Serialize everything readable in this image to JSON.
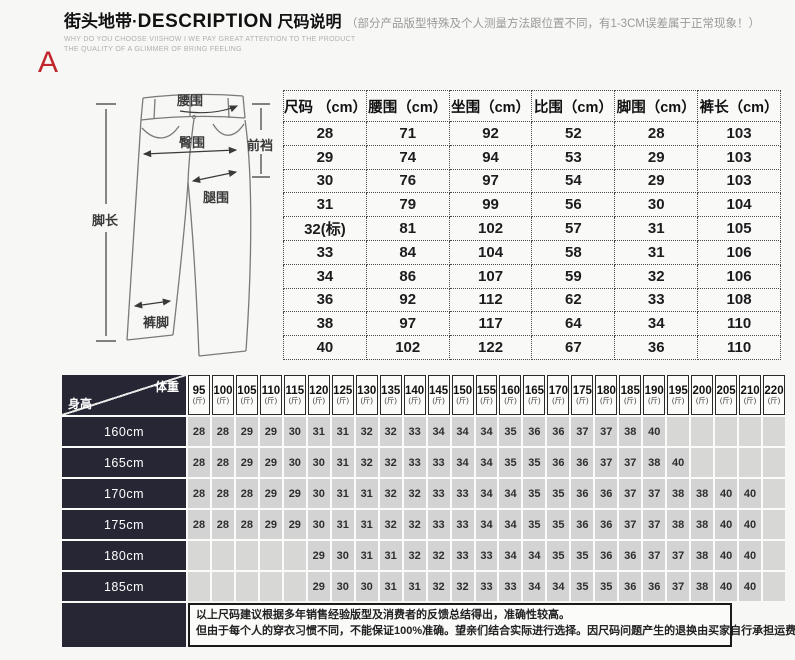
{
  "colors": {
    "accent_red": "#c0262c",
    "dark_header": "#262634",
    "cell_gray": "#d3d3d3"
  },
  "page": {
    "marker_label": "A"
  },
  "header": {
    "brand": "街头地带",
    "dot": "·",
    "title_en": "DESCRIPTION",
    "title_cn": "尺码说明",
    "note": "（部分产品版型特殊及个人测量方法跟位置不同，有1-3CM误差属于正常现象！）",
    "subtitle_line1": "WHY DO YOU CHOOSE VIISHOW I WE PAY GREAT ATTENTION TO THE PRODUCT",
    "subtitle_line2": "THE QUALITY OF A GLIMMER OF BRING FEELING"
  },
  "diagram": {
    "labels": {
      "waist": "腰围",
      "hip": "臀围",
      "front_rise": "前裆",
      "thigh": "腿围",
      "leg_length": "脚长",
      "leg_opening": "裤脚"
    }
  },
  "size_table": {
    "headers": [
      "尺码 （cm）",
      "腰围（cm）",
      "坐围（cm）",
      "比围（cm）",
      "脚围（cm）",
      "裤长（cm）"
    ],
    "rows": [
      [
        "28",
        "71",
        "92",
        "52",
        "28",
        "103"
      ],
      [
        "29",
        "74",
        "94",
        "53",
        "29",
        "103"
      ],
      [
        "30",
        "76",
        "97",
        "54",
        "29",
        "103"
      ],
      [
        "31",
        "79",
        "99",
        "56",
        "30",
        "104"
      ],
      [
        "32(标)",
        "81",
        "102",
        "57",
        "31",
        "105"
      ],
      [
        "33",
        "84",
        "104",
        "58",
        "31",
        "106"
      ],
      [
        "34",
        "86",
        "107",
        "59",
        "32",
        "106"
      ],
      [
        "36",
        "92",
        "112",
        "62",
        "33",
        "108"
      ],
      [
        "38",
        "97",
        "117",
        "64",
        "34",
        "110"
      ],
      [
        "40",
        "102",
        "122",
        "67",
        "36",
        "110"
      ]
    ]
  },
  "matrix_table": {
    "corner_top": "体重",
    "corner_bottom": "身高",
    "weight_unit": "(斤)",
    "weights": [
      "95",
      "100",
      "105",
      "110",
      "115",
      "120",
      "125",
      "130",
      "135",
      "140",
      "145",
      "150",
      "155",
      "160",
      "165",
      "170",
      "175",
      "180",
      "185",
      "190",
      "195",
      "200",
      "205",
      "210",
      "220"
    ],
    "rows": [
      {
        "height": "160cm",
        "values": [
          "28",
          "28",
          "29",
          "29",
          "30",
          "31",
          "31",
          "32",
          "32",
          "33",
          "34",
          "34",
          "34",
          "35",
          "36",
          "36",
          "37",
          "37",
          "38",
          "40",
          "",
          "",
          "",
          "",
          ""
        ]
      },
      {
        "height": "165cm",
        "values": [
          "28",
          "28",
          "29",
          "29",
          "30",
          "30",
          "31",
          "32",
          "32",
          "33",
          "33",
          "34",
          "34",
          "35",
          "35",
          "36",
          "36",
          "37",
          "37",
          "38",
          "40",
          "",
          "",
          "",
          ""
        ]
      },
      {
        "height": "170cm",
        "values": [
          "28",
          "28",
          "28",
          "29",
          "29",
          "30",
          "31",
          "31",
          "32",
          "32",
          "33",
          "33",
          "34",
          "34",
          "35",
          "35",
          "36",
          "36",
          "37",
          "37",
          "38",
          "38",
          "40",
          "40",
          ""
        ]
      },
      {
        "height": "175cm",
        "values": [
          "28",
          "28",
          "28",
          "29",
          "29",
          "30",
          "31",
          "31",
          "32",
          "32",
          "33",
          "33",
          "34",
          "34",
          "35",
          "35",
          "36",
          "36",
          "37",
          "37",
          "38",
          "38",
          "40",
          "40",
          ""
        ]
      },
      {
        "height": "180cm",
        "values": [
          "",
          "",
          "",
          "",
          "",
          "29",
          "30",
          "31",
          "31",
          "32",
          "32",
          "33",
          "33",
          "34",
          "34",
          "35",
          "35",
          "36",
          "36",
          "37",
          "37",
          "38",
          "40",
          "40",
          ""
        ]
      },
      {
        "height": "185cm",
        "values": [
          "",
          "",
          "",
          "",
          "",
          "29",
          "30",
          "30",
          "31",
          "31",
          "32",
          "32",
          "33",
          "33",
          "34",
          "34",
          "35",
          "35",
          "36",
          "36",
          "37",
          "38",
          "40",
          "40",
          ""
        ]
      }
    ]
  },
  "footer": {
    "line1": "以上尺码建议根据多年销售经验版型及消费者的反馈总结得出，准确性较高。",
    "line2": "但由于每个人的穿衣习惯不同，不能保证100%准确。望亲们结合实际进行选择。因尺码问题产生的退换由买家自行承担运费。"
  }
}
